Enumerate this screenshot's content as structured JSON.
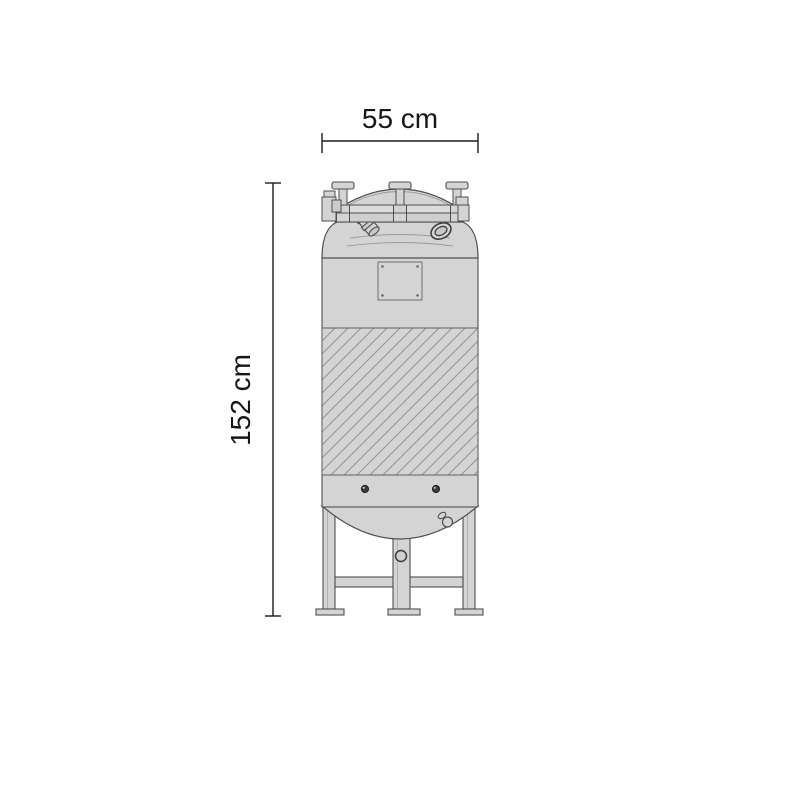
{
  "diagram": {
    "kind": "technical-drawing",
    "subject": "vertical storage tank, front elevation",
    "width_label": "55 cm",
    "height_label": "152 cm",
    "colors": {
      "background": "#ffffff",
      "body_fill": "#d4d4d4",
      "outline": "#4f4f4f",
      "thin_line": "#9a9a9a",
      "hatch_line": "#939393",
      "dimension_line": "#1a1a1a",
      "dark_fitting": "#3a3a3a"
    }
  }
}
